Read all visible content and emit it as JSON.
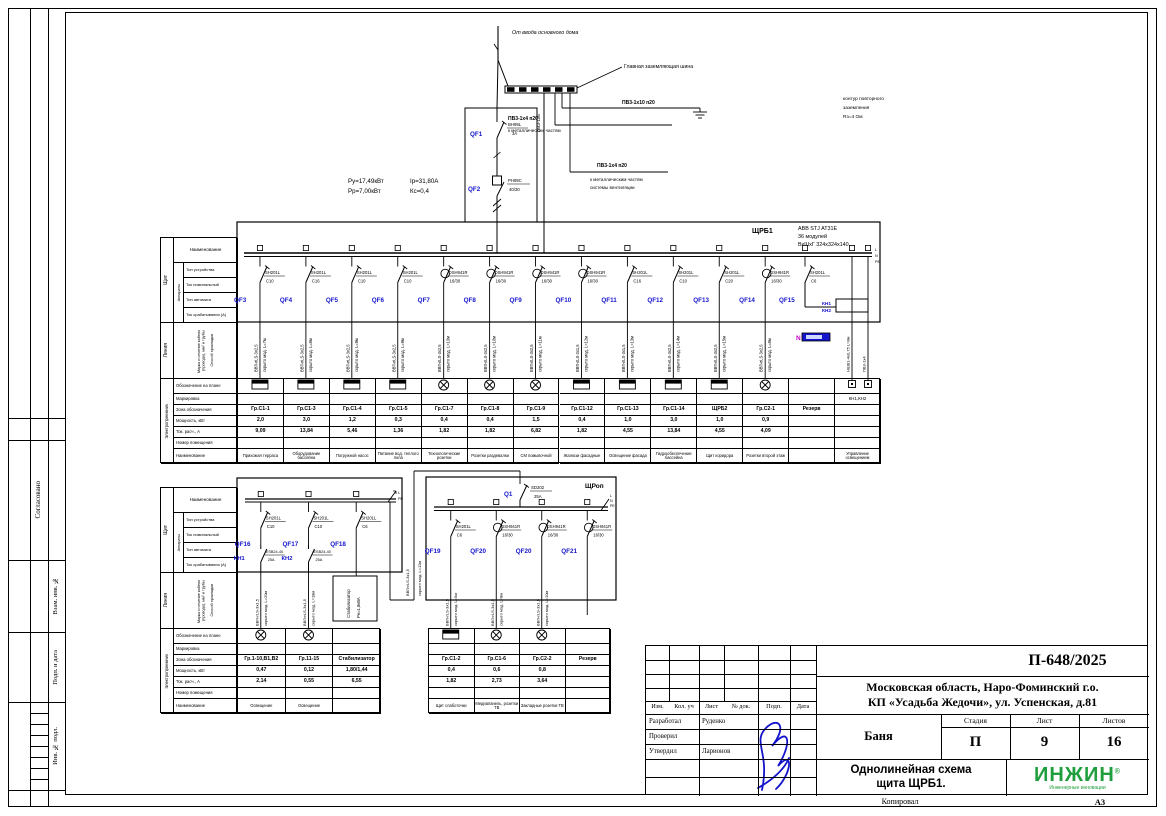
{
  "page": {
    "copied": "Копировал",
    "format": "А3"
  },
  "margin": {
    "stamps": [
      "Согласовано",
      "Взам. инв. №",
      "Подп. и дата",
      "Инв. № подл."
    ]
  },
  "feeder": {
    "source": "От ввода основного дома",
    "gzsh": "Главная заземляющая шина",
    "branch_ground": {
      "cable": "ПВ3-1х10 п20",
      "note1": "контур повторного",
      "note2": "заземления",
      "note3": "Rз=4 Ом"
    },
    "branch_metal": {
      "cable": "ПВ3-1х4 п20",
      "note1": "к металлическим частям"
    },
    "branch_vent": {
      "cable": "ПВ3-1х4 п20",
      "note1": "к металлическим частям",
      "note2": "системы вентиляции"
    },
    "pe_riser": "ПВ3-1х6",
    "calc": [
      "Ру=17,49кВт",
      "Рр=7,00кВт",
      "Iр=31,80А",
      "Кс=0,4"
    ],
    "qf1": {
      "id": "QF1",
      "type": "ВН99L",
      "rating": "3А"
    },
    "qf2": {
      "id": "QF2",
      "type": "РН99С",
      "rating": "40/30"
    }
  },
  "header_table": {
    "group_panel": "Щит",
    "row_name": "Наименование",
    "group_device": "Аппараты",
    "device_rows": [
      "Тип устройства",
      "Ток номинальный",
      "Тип автомата",
      "Ток срабатывания (А)"
    ],
    "group_line": "Линия",
    "line_rows": [
      "Марка и сечение кабеля (провода), мм² и трубы",
      "Способ прокладки"
    ],
    "group_consumer": "Электроприемник",
    "consumer_rows": [
      "Обозначение на плане",
      "Маркировка",
      "Зона обозначения",
      "Мощность, кВт",
      "Ток. расч., А",
      "Номер помещения",
      "Наименование"
    ]
  },
  "panel_main": {
    "name": "ЩРБ1",
    "spec": [
      "ABB STJ AT31E",
      "36 модулей",
      "ВхШхГ 324х324х140"
    ],
    "bus_end": [
      "L",
      "N",
      "PE"
    ],
    "kn_labels": [
      "КН1",
      "КН2"
    ],
    "n_label": "N",
    "aux_cables": [
      "НШВ1-4х0,75 L=8м",
      "ПВ3-1х4"
    ],
    "breakers": [
      {
        "id": "QF3",
        "type": "SH201L",
        "rating": "C10",
        "diff": false
      },
      {
        "id": "QF4",
        "type": "SH201L",
        "rating": "C16",
        "diff": false
      },
      {
        "id": "QF5",
        "type": "SH201L",
        "rating": "C10",
        "diff": false
      },
      {
        "id": "QF6",
        "type": "SH201L",
        "rating": "C10",
        "diff": false
      },
      {
        "id": "QF7",
        "type": "DSH941R",
        "rating": "16/30",
        "diff": true
      },
      {
        "id": "QF8",
        "type": "DSH941R",
        "rating": "16/30",
        "diff": true
      },
      {
        "id": "QF9",
        "type": "DSH941R",
        "rating": "16/30",
        "diff": true
      },
      {
        "id": "QF10",
        "type": "DSH941R",
        "rating": "16/30",
        "diff": true
      },
      {
        "id": "QF11",
        "type": "SH201L",
        "rating": "C16",
        "diff": false
      },
      {
        "id": "QF12",
        "type": "SH201L",
        "rating": "C10",
        "diff": false
      },
      {
        "id": "QF13",
        "type": "SH201L",
        "rating": "C20",
        "diff": false
      },
      {
        "id": "QF14",
        "type": "DSH941R",
        "rating": "16/30",
        "diff": true
      },
      {
        "id": "QF15",
        "type": "SH201L",
        "rating": "C6",
        "diff": false
      }
    ],
    "columns": [
      {
        "group": "Гр.С1-1",
        "p": "2,0",
        "i": "9,09",
        "name": "Прихожая терраса",
        "symbol": "socket",
        "cable": "ВВГнгLS-3х2,5",
        "lay": "скрыто мод. L=7м"
      },
      {
        "group": "Гр.С1-3",
        "p": "3,0",
        "i": "13,84",
        "name": "Оборудование бассейна",
        "symbol": "socket",
        "cable": "ВВГнгLS-3х2,5",
        "lay": "скрыто мод. L=8м"
      },
      {
        "group": "Гр.С1-4",
        "p": "1,2",
        "i": "5,46",
        "name": "Погружной насос",
        "symbol": "socket",
        "cable": "ВВГнгLS-3х2,5",
        "lay": "скрыто мод. L=9м"
      },
      {
        "group": "Гр.С1-5",
        "p": "0,3",
        "i": "1,36",
        "name": "Питание вод. теплого пола",
        "symbol": "socket",
        "cable": "ВВГнгLS-3х2,5",
        "lay": "скрыто мод. L=9м"
      },
      {
        "group": "Гр.С1-7",
        "p": "0,4",
        "i": "1,82",
        "name": "Технологические розетки",
        "symbol": "lamp",
        "cable": "ВВГнгLS-3х2,5",
        "lay": "скрыто мод. L=10м"
      },
      {
        "group": "Гр.С1-8",
        "p": "0,4",
        "i": "1,82",
        "name": "Розетки раздевалки",
        "symbol": "lamp",
        "cable": "ВВГнгLS-3х2,5",
        "lay": "скрыто мод. L=10м"
      },
      {
        "group": "Гр.С1-9",
        "p": "1,5",
        "i": "6,82",
        "name": "СМ помывочной",
        "symbol": "lamp",
        "cable": "ВВГнгLS-3х2,5",
        "lay": "скрыто мод. L=11м"
      },
      {
        "group": "Гр.С1-12",
        "p": "0,4",
        "i": "1,82",
        "name": "Жалюзи фасадные",
        "symbol": "socket",
        "cable": "ВВГнгLS-3х1,5",
        "lay": "скрыто мод. L=12м"
      },
      {
        "group": "Гр.С1-13",
        "p": "1,0",
        "i": "4,55",
        "name": "Освещение фасада",
        "symbol": "socket",
        "cable": "ВВГнгLS-3х1,5",
        "lay": "скрыто мод. L=13м"
      },
      {
        "group": "Гр.С1-14",
        "p": "3,0",
        "i": "13,84",
        "name": "Гидрообеспечение бассейна",
        "symbol": "socket",
        "cable": "ВВГнгLS-3х2,5",
        "lay": "скрыто мод. L=14м"
      },
      {
        "group": "ЩРБ2",
        "p": "1,0",
        "i": "4,55",
        "name": "Щит коридора",
        "symbol": "socket",
        "cable": "ВВГнгLS-3х2,5",
        "lay": "скрыто мод. L=15м"
      },
      {
        "group": "Гр.С2-1",
        "p": "0,9",
        "i": "4,09",
        "name": "Розетки второй этаж",
        "symbol": "lamp",
        "cable": "ВВГнгLS-3х2,5",
        "lay": "скрыто мод. L=8м"
      },
      {
        "group": "Резерв",
        "p": "",
        "i": "",
        "name": "",
        "symbol": "none",
        "cable": "",
        "lay": ""
      },
      {
        "group": "",
        "p": "",
        "i": "",
        "name": "Управление освещением",
        "symbol": "squares",
        "cable": "",
        "lay": "",
        "marking": "КН1,КН2"
      }
    ]
  },
  "panel_light": {
    "breakers": [
      {
        "id": "QF16",
        "type": "SH201L",
        "rating": "C10",
        "diff": false
      },
      {
        "id": "QF17",
        "type": "SH201L",
        "rating": "C10",
        "diff": false
      },
      {
        "id": "QF18",
        "type": "SH201L",
        "rating": "C6",
        "diff": false
      }
    ],
    "contactors": [
      {
        "id": "КН1",
        "type": "ESB24-40",
        "rating": "25А"
      },
      {
        "id": "КН2",
        "type": "ESB24-40",
        "rating": "25А"
      }
    ],
    "bus_end": [
      "L",
      "PE"
    ],
    "stab": [
      "Стабилизатор",
      "Рн=1,8кВА"
    ],
    "feed_cable": [
      "ВВГнгLS-3х1,5",
      "скрыто мод. L=12м"
    ],
    "columns": [
      {
        "group": "Гр.1-10,В1,В2",
        "p": "0,47",
        "i": "2,14",
        "name": "Освещение",
        "symbol": "lamp",
        "cable": "ВВГнгLS-3х1,5",
        "lay": "скрыто мод. L=20м"
      },
      {
        "group": "Гр.11-15",
        "p": "0,12",
        "i": "0,55",
        "name": "Освещение",
        "symbol": "lamp",
        "cable": "ВВГнгLS-3х1,5",
        "lay": "скрыто мод. L=18м"
      },
      {
        "group": "Стабилизатор",
        "p": "1,80/1,44",
        "i": "6,55",
        "name": "",
        "symbol": "stab",
        "cable": "",
        "lay": ""
      }
    ]
  },
  "panel_shrop": {
    "name": "ЩРоп",
    "q1": {
      "id": "Q1",
      "type": "SD202",
      "rating": "25А"
    },
    "bus_end": [
      "L",
      "N",
      "PE"
    ],
    "breakers": [
      {
        "id": "QF19",
        "type": "SH201L",
        "rating": "C6",
        "diff": false
      },
      {
        "id": "QF20",
        "type": "DSH941R",
        "rating": "16/30",
        "diff": true
      },
      {
        "id": "QF20",
        "type": "DSH941R",
        "rating": "16/30",
        "diff": true
      },
      {
        "id": "QF21",
        "type": "DSH941R",
        "rating": "16/30",
        "diff": true
      }
    ],
    "columns": [
      {
        "group": "Гр.С1-2",
        "p": "0,4",
        "i": "1,82",
        "name": "Щит слаботочки",
        "symbol": "socket",
        "cable": "ВВГнгLS-3х1,5",
        "lay": "скрыто мод. L=5м"
      },
      {
        "group": "Гр.С1-6",
        "p": "0,6",
        "i": "2,73",
        "name": "Медиапанель, розетки ТВ",
        "symbol": "lamp",
        "cable": "ВВГнгLS-3х1,5",
        "lay": "скрыто мод. L=8м"
      },
      {
        "group": "Гр.С2-2",
        "p": "0,8",
        "i": "3,64",
        "name": "Закладные розетки ТВ",
        "symbol": "lamp",
        "cable": "ВВГнгLS-3х1,5",
        "lay": "скрыто мод. L=10м"
      },
      {
        "group": "Резерв",
        "p": "",
        "i": "",
        "name": "",
        "symbol": "none",
        "cable": "",
        "lay": ""
      }
    ]
  },
  "title_block": {
    "doc_number": "П-648/2025",
    "address1": "Московская область, Наро-Фоминский г.о.",
    "address2": "КП «Усадьба Жедочи», ул. Успенская, д.81",
    "object_name": "Баня",
    "sheet_title1": "Однолинейная схема",
    "sheet_title2": "щита ЩРБ1.",
    "stage_label": "Стадия",
    "sheet_label": "Лист",
    "sheets_label": "Листов",
    "stage": "П",
    "sheet": "9",
    "sheets": "16",
    "header_cols": [
      "Изм.",
      "Кол. уч",
      "Лист",
      "№ док.",
      "Подп.",
      "Дата"
    ],
    "roles": [
      {
        "role": "Разработал",
        "name": "Руденко"
      },
      {
        "role": "Проверил",
        "name": ""
      },
      {
        "role": "Утвердил",
        "name": "Ларионов"
      }
    ],
    "logo_text": "ИНЖИН",
    "logo_reg": "®",
    "logo_sub": "Инженерные инновации",
    "logo_color": "#1f9e3d",
    "accent_blue": "#1414cc",
    "accent_magenta": "#cc00cc"
  }
}
